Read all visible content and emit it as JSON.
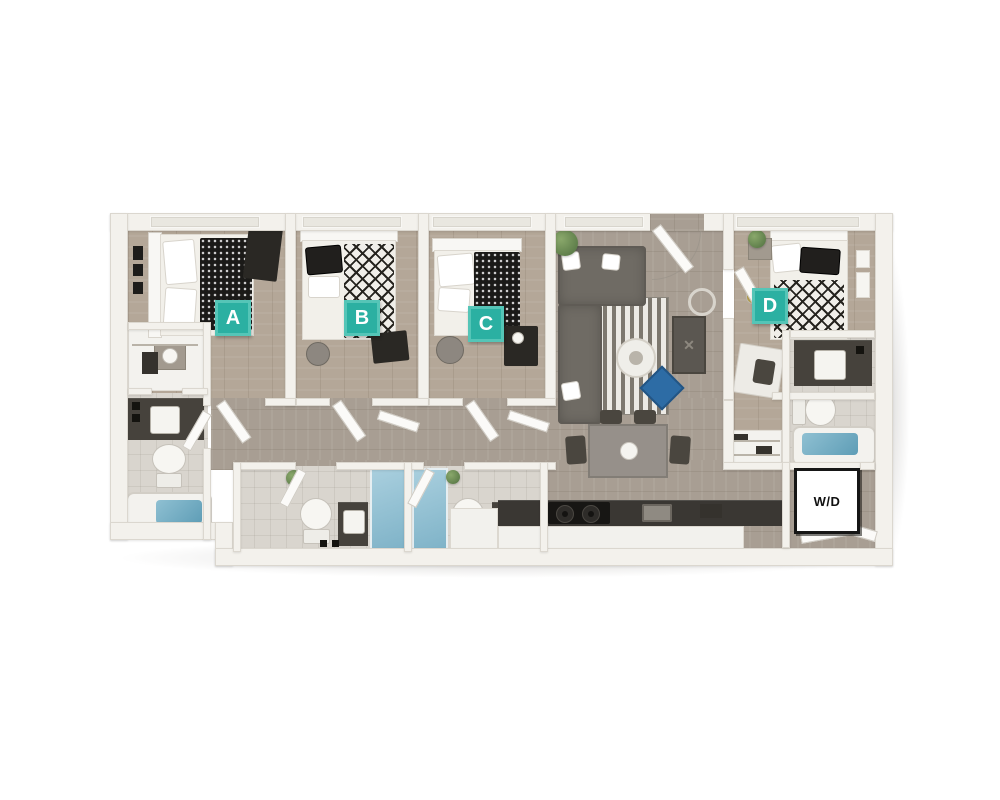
{
  "floorplan": {
    "bedroom_labels": {
      "a": "A",
      "b": "B",
      "c": "C",
      "d": "D"
    },
    "laundry_label": "W/D",
    "console_mark": "✕",
    "colors": {
      "label_background": "#2bb0a2",
      "label_border": "#55c5b7",
      "label_text": "#ffffff",
      "laundry_background": "#ffffff",
      "laundry_border": "#161616",
      "laundry_text": "#111111",
      "page_background": "#ffffff",
      "wall": "#f3f1ec",
      "wood_floor": "#b4a798",
      "tile_floor": "#d9d5ce",
      "water_blue": "#6fa9bf",
      "accent_blue": "#2d6ca5",
      "sofa_gray": "#6f6b64",
      "duvet_black": "#1b1a18"
    }
  }
}
